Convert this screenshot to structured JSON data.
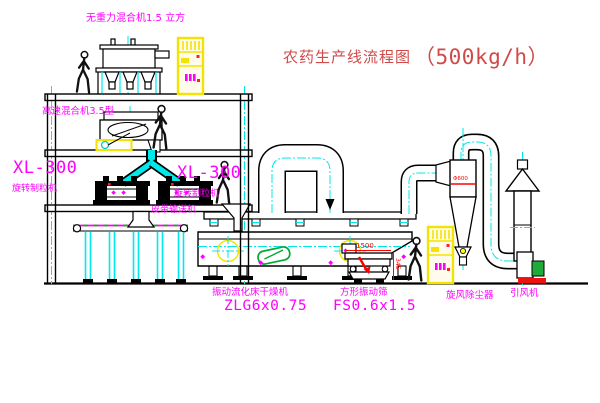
{
  "title": {
    "name": "农药生产线流程图",
    "capacity": "（500kg/h）"
  },
  "equipment_labels": {
    "gravity_mixer": "无重力混合机1.5 立方",
    "high_speed_mixer": "高速混合机3.5型",
    "granulator_left": {
      "model": "XL-300",
      "name": "旋转制粒机"
    },
    "granulator_right": {
      "model": "XL-300",
      "name": "旋转制粒机"
    },
    "belt_conveyor": "皮带输送机",
    "fluid_bed_dryer": {
      "name": "振动流化床干燥机",
      "model": "ZLG6x0.75"
    },
    "square_sieve": {
      "name": "方形振动筛",
      "model": "FS0.6x1.5"
    },
    "cyclone": "旋风除尘器",
    "induced_fan": "引风机"
  },
  "dimensions": {
    "sieve_length": "1500",
    "sieve_height": "345",
    "cyclone_marking": "Φ600"
  },
  "colors": {
    "label_magenta": "#ff00ff",
    "title_red": "#d04a4a",
    "dimension_red": "#ff0000",
    "centerline_cyan": "#00e8e8",
    "cabinet_yellow": "#f2e300",
    "machine_black": "#000000",
    "motor_green": "#1faa3c"
  }
}
